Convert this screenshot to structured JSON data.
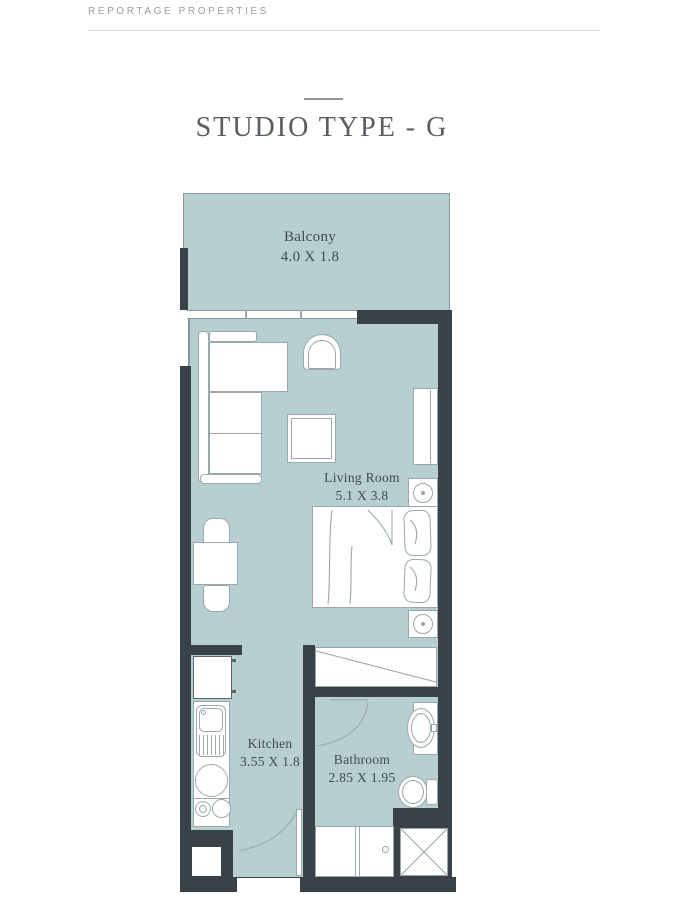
{
  "page": {
    "brand": "REPORTAGE PROPERTIES"
  },
  "title": "STUDIO TYPE - G",
  "rooms": {
    "balcony": {
      "name": "Balcony",
      "dims": "4.0 X 1.8"
    },
    "living_room": {
      "name": "Living Room",
      "dims": "5.1 X 3.8"
    },
    "kitchen": {
      "name": "Kitchen",
      "dims": "3.55 X 1.8"
    },
    "bathroom": {
      "name": "Bathroom",
      "dims": "2.85 X 1.95"
    }
  },
  "colors": {
    "floor": "#b8cfd1",
    "wall": "#3a4147",
    "furniture_line": "#9aa8ab",
    "label_text": "#3f4a51",
    "brand_text": "#9c9c9c",
    "title_text": "#585d62",
    "divider_line": "#d9d9d9"
  }
}
